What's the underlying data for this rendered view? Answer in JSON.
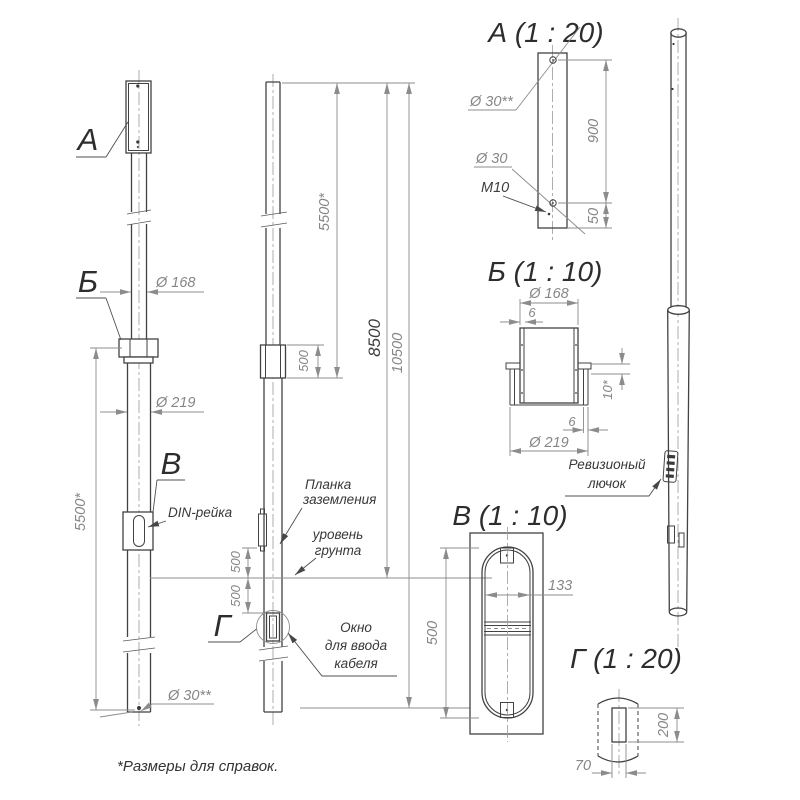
{
  "note": "*Размеры для справок.",
  "callouts": {
    "a": "А",
    "b": "Б",
    "v": "В",
    "g": "Г"
  },
  "front_view": {
    "dia168": "Ø 168",
    "dia219": "Ø 219",
    "dia30ref": "Ø 30**",
    "len5500": "5500*",
    "din_label": "DIN-рейка"
  },
  "section_view": {
    "sleeve500": "500",
    "len5500": "5500*",
    "len8500": "8500",
    "len10500": "10500",
    "above500": "500",
    "below500": "500",
    "plank_label": [
      "Планка",
      "заземления"
    ],
    "ground_label": [
      "уровень",
      "грунта"
    ],
    "window_label": [
      "Окно",
      "для ввода",
      "кабеля"
    ]
  },
  "detail_a": {
    "title": "А (1 : 20)",
    "dia30ref": "Ø 30**",
    "dia30": "Ø 30",
    "thread": "M10",
    "h900": "900",
    "h50": "50"
  },
  "detail_b": {
    "title": "Б (1 : 10)",
    "dia168": "Ø 168",
    "wall6_top": "6",
    "gap10": "10*",
    "wall6_bot": "6",
    "dia219": "Ø 219"
  },
  "detail_v": {
    "title": "В (1 : 10)",
    "h500": "500",
    "w133": "133"
  },
  "detail_g": {
    "title": "Г (1 : 20)",
    "h200": "200",
    "w70": "70"
  },
  "iso_view": {
    "hatch_label": [
      "Ревизионый",
      "лючок"
    ]
  }
}
